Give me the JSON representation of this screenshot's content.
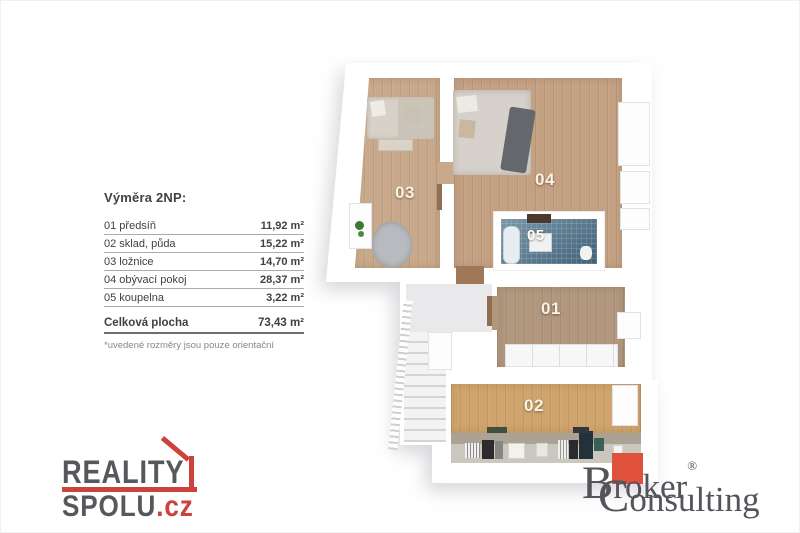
{
  "colors": {
    "text-dark": "#414042",
    "text-gray": "#85878a",
    "line-gray": "#a9abae",
    "total-line": "#6d6e71",
    "reality-gray": "#57585b",
    "reality-red": "#cb433c",
    "broker-gray": "#54555a",
    "broker-red": "#e0513c",
    "floor-a": "#c9a98b",
    "floor-a2": "#c4a183",
    "floor-b": "#b0977e",
    "floor-c": "#cfa46d",
    "bath-blue": "#587e95"
  },
  "area_table": {
    "title": "Výměra 2NP:",
    "rows": [
      {
        "label": "01 předsíň",
        "value": "11,92 m²"
      },
      {
        "label": "02 sklad, půda",
        "value": "15,22 m²"
      },
      {
        "label": "03 ložnice",
        "value": "14,70 m²"
      },
      {
        "label": "04 obývací pokoj",
        "value": "28,37 m²"
      },
      {
        "label": "05 koupelna",
        "value": "3,22 m²"
      }
    ],
    "total": {
      "label": "Celková plocha",
      "value": "73,43 m²"
    },
    "note": "*uvedené rozměry jsou pouze orientační"
  },
  "floorplan": {
    "labels": {
      "room01": "01",
      "room02": "02",
      "room03": "03",
      "room04": "04",
      "room05": "05"
    }
  },
  "logos": {
    "reality": {
      "line1": "REALITY",
      "line2": "SPOLU",
      "tld": ".cz"
    },
    "broker": {
      "word1_initial": "B",
      "word1_rest": "roker",
      "reg": "®",
      "word2_initial": "C",
      "word2_rest": "onsulting"
    }
  }
}
